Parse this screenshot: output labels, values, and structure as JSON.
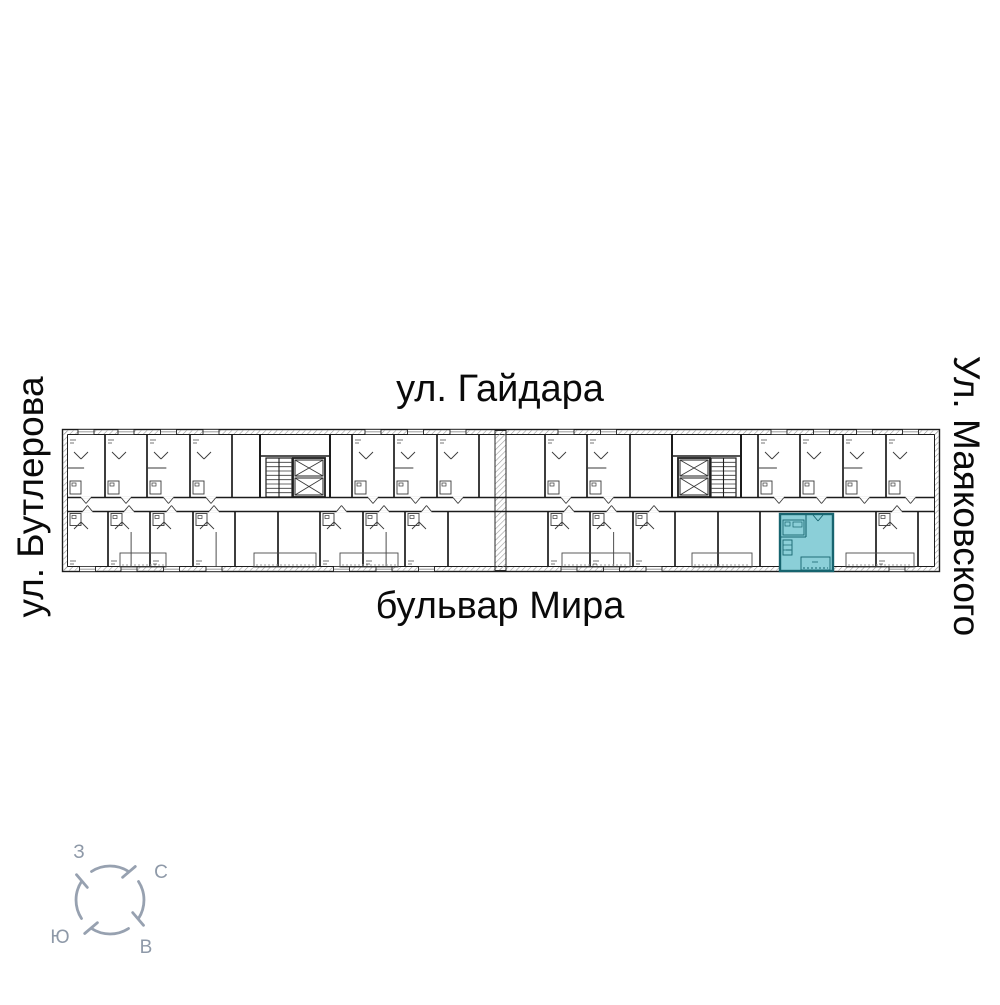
{
  "page": {
    "background": "#ffffff"
  },
  "streets": {
    "top": "ул. Гайдара",
    "bottom": "бульвар Мира",
    "left": "ул. Бутлерова",
    "right": "Ул. Маяковского",
    "color": "#0a0a0a"
  },
  "compass": {
    "labels": {
      "west": "З",
      "north": "С",
      "south": "Ю",
      "east": "В"
    },
    "label_positions": {
      "west": [
        79,
        858
      ],
      "north": [
        161,
        878
      ],
      "south": [
        60,
        943
      ],
      "east": [
        146,
        953
      ]
    },
    "center": {
      "x": 110,
      "y": 900
    },
    "radius": 34,
    "color": "#97a1b0",
    "text_color": "#8e99a8"
  },
  "floorplan": {
    "bounds": {
      "x": 62,
      "y": 429,
      "w": 878,
      "h": 143
    },
    "colors": {
      "wall": "#1c1c1c",
      "line": "#3a3a3a",
      "faint": "#666666",
      "hatch": "#9b9b9b",
      "highlight_fill": "#8bcfd8",
      "highlight_wall": "#17646f"
    },
    "corridor": {
      "top": 497.5,
      "bottom": 511.5,
      "x1": 67,
      "x2": 935
    },
    "joint": {
      "x": 495,
      "w": 11
    },
    "cores": [
      {
        "stair": {
          "x": 266,
          "y": 458,
          "w": 26,
          "h": 39
        },
        "lifts": {
          "x": 293,
          "y": 458,
          "w": 32,
          "h": 39
        },
        "span": [
          260,
          330
        ]
      },
      {
        "lifts": {
          "x": 678,
          "y": 458,
          "w": 32,
          "h": 39
        },
        "stair": {
          "x": 711,
          "y": 458,
          "w": 25,
          "h": 39
        },
        "span": [
          672,
          741
        ]
      }
    ],
    "top_dividers": [
      105,
      147,
      190,
      232,
      352,
      394,
      437,
      479,
      545,
      587,
      630,
      758,
      800,
      843,
      886
    ],
    "bottom_dividers": [
      108,
      150,
      193,
      235,
      278,
      320,
      363,
      405,
      448,
      548,
      590,
      633,
      675,
      718,
      760,
      876,
      918
    ],
    "balconies_bottom": [
      [
        120,
        166
      ],
      [
        254,
        316
      ],
      [
        340,
        398
      ],
      [
        562,
        630
      ],
      [
        692,
        752
      ],
      [
        846,
        914
      ]
    ],
    "highlight": {
      "x": 780,
      "y": 514,
      "w": 53,
      "h": 57
    }
  }
}
